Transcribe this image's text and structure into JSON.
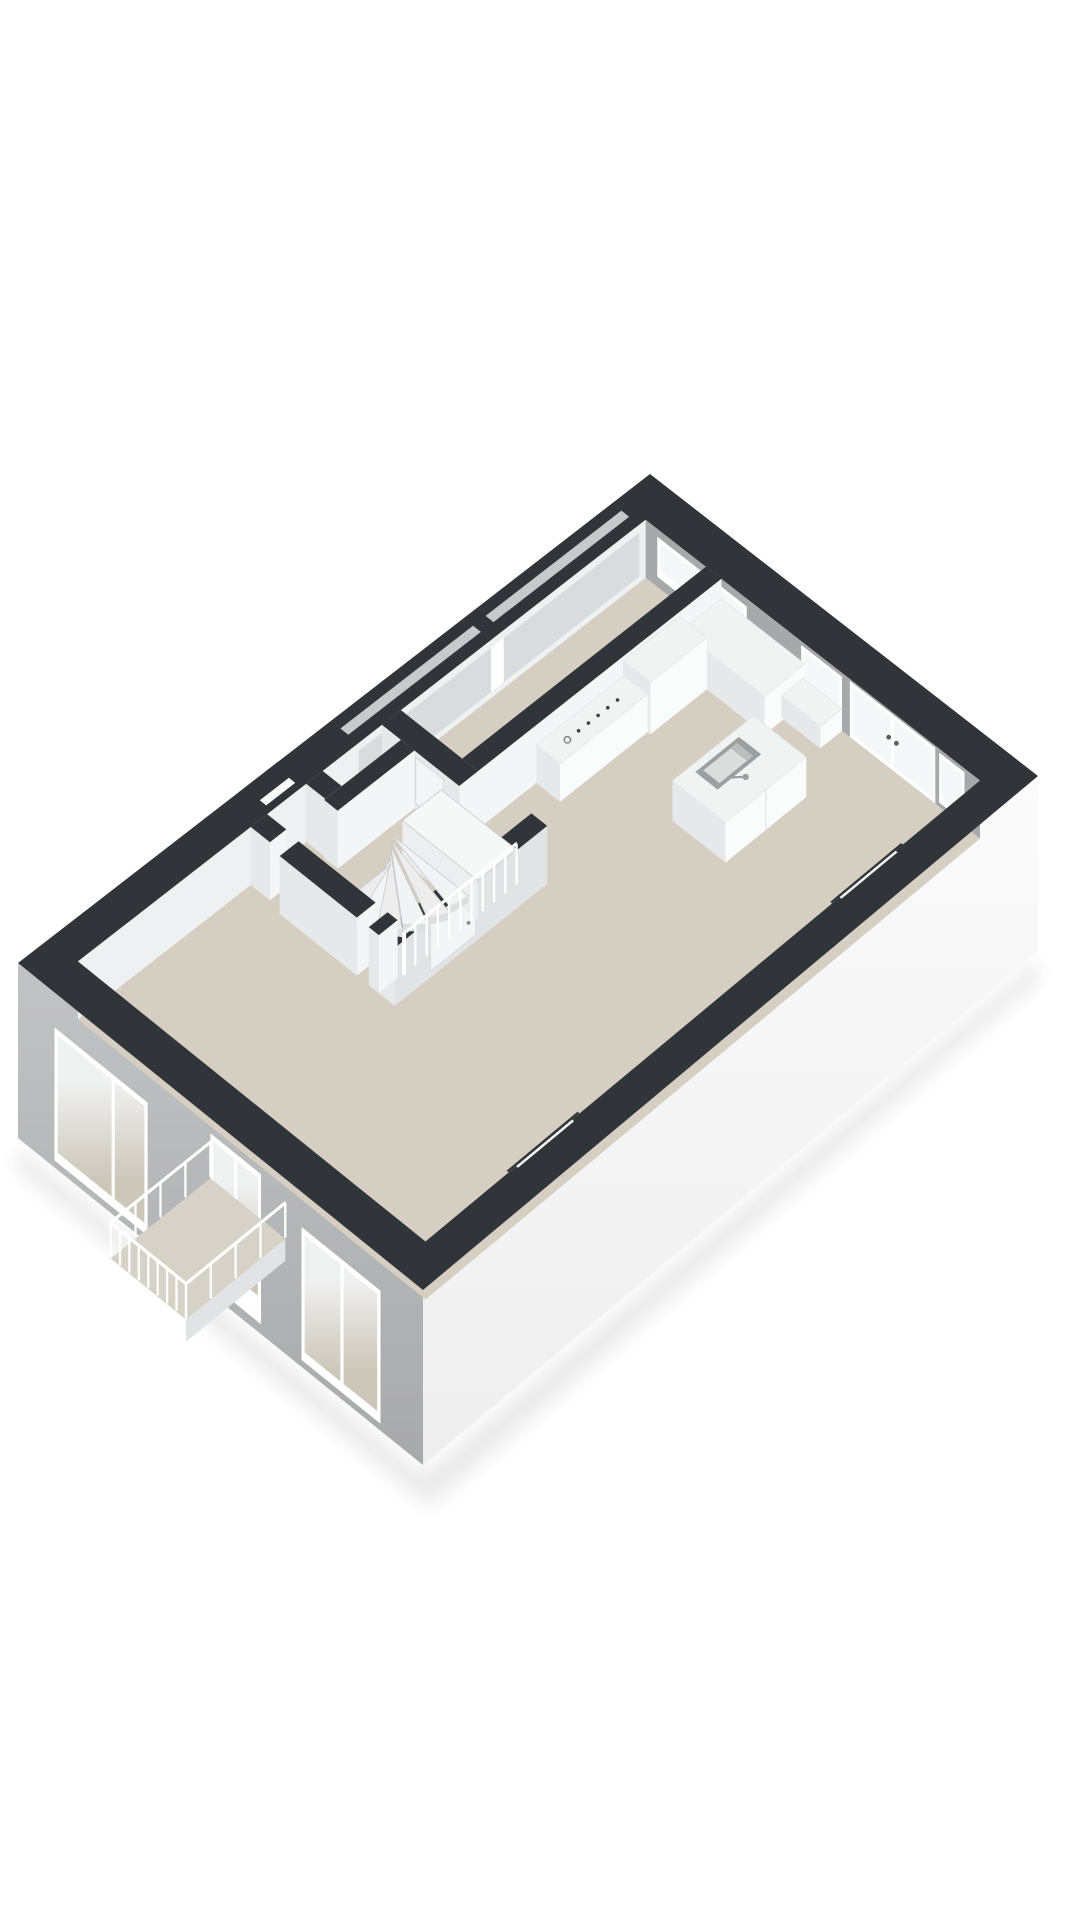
{
  "meta": {
    "figure": "isometric-3d-floorplan-render",
    "floor_label": ""
  },
  "colors": {
    "background": "#ffffff",
    "wallTop": "#313438",
    "floor": "#d5cfc3",
    "floorLight": "#dbd5c9",
    "balconyFloor": "#d7d2c8",
    "neInner": "#a6a8aa",
    "nwInner": "#eff0f2",
    "nwGlazing": "#d9dcdd",
    "bandCutGlass": "#c7cacc",
    "seFaceTop": "#fbfbfb",
    "seFaceBot": "#eeeeee",
    "swFaceTop": "#c2c3c5",
    "swFaceBot": "#a8a9ab",
    "glassNE": "#f5f7f8",
    "glassSWTop": "#eff0f0",
    "glassSWBot": "#cdc7bb",
    "frame": "#ffffff",
    "frameShade": "#e2e3e5",
    "wallFaceSE": "#f4f5f6",
    "wallFaceSW": "#e7e8ea",
    "wallFaceShaded": "#e2e3e5",
    "boxTop": "#f1f2f2",
    "boxSE": "#fafbfb",
    "boxSW": "#e7e8e9",
    "treads": "#f2f3f4",
    "treadEdge": "#c9cacc",
    "landing": "#f6f7f7",
    "rail": "#ffffff",
    "railShade": "#d8d9db",
    "sinkRim": "#9aa0a0",
    "sinkBasin": "#d9dddc",
    "sinkShadow": "#b9bebd",
    "faucet": "#9aa0a2",
    "handle": "#5b5e60",
    "doorLeaf": "#f3f4f5",
    "doorFrame": "#d8d9db",
    "shadow": "#3a3b40"
  },
  "scene": {
    "corners": {
      "n": [
        650,
        474
      ],
      "e": [
        1038,
        776
      ],
      "w": [
        18,
        963
      ],
      "s": [
        423,
        1290
      ]
    },
    "ta": 0.07,
    "tb": 0.05,
    "floorZ": -58,
    "slabZ": -175,
    "ne_openings": [
      {
        "name": "ne-window-double",
        "a1": 0.1,
        "a2": 0.33,
        "z1": -8,
        "z2": -48,
        "mullions": [
          0.215
        ],
        "door": false
      },
      {
        "name": "ne-window-tall",
        "a1": 0.47,
        "a2": 0.575,
        "z1": -4,
        "z2": -54,
        "mullions": [],
        "door": false
      },
      {
        "name": "ne-french-doors",
        "a1": 0.595,
        "a2": 0.815,
        "z1": -2,
        "z2": -58,
        "mullions": [
          0.705
        ],
        "door": true,
        "handles": [
          [
            0.695,
            -28
          ],
          [
            0.715,
            -28
          ]
        ]
      },
      {
        "name": "ne-window-side",
        "a1": 0.825,
        "a2": 0.89,
        "z1": -4,
        "z2": -54,
        "mullions": [],
        "door": false
      }
    ],
    "sw_openings": [
      {
        "name": "sw-window-a",
        "a1": 0.09,
        "a2": 0.32,
        "z1": -35,
        "z2": -168,
        "mullions": [
          0.235
        ],
        "door": false
      },
      {
        "name": "sw-balcony-doors",
        "a1": 0.475,
        "a2": 0.6,
        "z1": -15,
        "z2": -165,
        "mullions": [
          0.5375
        ],
        "door": true,
        "handles": [
          [
            0.528,
            -82
          ],
          [
            0.548,
            -82
          ]
        ]
      },
      {
        "name": "sw-window-b",
        "a1": 0.7,
        "a2": 0.895,
        "z1": -35,
        "z2": -168,
        "mullions": [
          0.8
        ],
        "door": false
      }
    ],
    "nw_glazing": {
      "b1": 0.06,
      "b2": 0.505,
      "z1": -8,
      "z2": -52,
      "gap1": 0.275,
      "gap2": 0.295,
      "cut_a1": 0.024,
      "cut_a2": 0.044
    },
    "entry_niche": {
      "b1": 0.588,
      "b2": 0.65,
      "depth": 0.055
    },
    "se_niches": [
      {
        "name": "se-niche-upper",
        "b1": 0.175,
        "b2": 0.29
      },
      {
        "name": "se-niche-lower",
        "b1": 0.7,
        "b2": 0.815
      }
    ],
    "niche_depth_a": 0.925,
    "niche_inset": 0.012,
    "walls": {
      "w1": {
        "a1": 0.225,
        "a2": 0.265,
        "b1": 0.05,
        "b2": 0.438
      },
      "w2": {
        "a1": 0.07,
        "a2": 0.265,
        "b1": 0.438,
        "b2": 0.468,
        "door": {
          "a1": 0.155,
          "a2": 0.225
        }
      },
      "stub1": {
        "a1": 0.07,
        "a2": 0.118,
        "b1": 0.562,
        "b2": 0.588
      },
      "stub2": {
        "a1": 0.07,
        "a2": 0.118,
        "b1": 0.65,
        "b2": 0.676
      },
      "w4": {
        "a1": 0.118,
        "a2": 0.152,
        "b1": 0.468,
        "b2": 0.59
      },
      "w3": {
        "a1": 0.4,
        "a2": 0.44,
        "b1": 0.438,
        "b2": 0.682,
        "door": {
          "b1": 0.552,
          "b2": 0.625
        }
      },
      "w5": {
        "a1": 0.152,
        "a2": 0.345,
        "b1": 0.652,
        "b2": 0.682
      },
      "w5post": {
        "a1": 0.375,
        "a2": 0.4,
        "b1": 0.652,
        "b2": 0.682
      }
    },
    "kitchen": {
      "counter_ne": {
        "a1": 0.265,
        "a2": 0.48,
        "b1": 0.05,
        "b2": 0.115,
        "z": -20
      },
      "cabinet_tall": {
        "a1": 0.262,
        "a2": 0.332,
        "b1": 0.115,
        "b2": 0.205,
        "z": -6
      },
      "counter_w1": {
        "a1": 0.265,
        "a2": 0.325,
        "b1": 0.205,
        "b2": 0.345,
        "z": -20
      },
      "ledge_ne": {
        "a1": 0.475,
        "a2": 0.575,
        "b1": 0.05,
        "b2": 0.085,
        "z": -36
      },
      "cooktop": {
        "a": 0.296,
        "b_start": 0.235,
        "b_step": 0.0155,
        "dots": 5,
        "ring_b": 0.315
      }
    },
    "island": {
      "a1": 0.5,
      "a2": 0.635,
      "b1": 0.145,
      "b2": 0.275,
      "z": -18,
      "sink": {
        "a1": 0.515,
        "a2": 0.572,
        "b1": 0.178,
        "b2": 0.248,
        "inset": 0.008
      },
      "faucet": {
        "a": 0.588,
        "b": 0.213
      }
    },
    "stairs": {
      "landing": {
        "a1": 0.22,
        "a2": 0.41,
        "b1": 0.468,
        "b2": 0.53,
        "z": -18
      },
      "newel": [
        0.215,
        0.545
      ],
      "ra": 0.195,
      "rb": 0.098,
      "tread_z": [
        -26,
        -32,
        -38,
        -44,
        -50,
        -56
      ],
      "rail": {
        "a": 0.41,
        "b1": 0.468,
        "b2": 0.648,
        "zTop": -10,
        "zBot": -52,
        "balusters": 10
      }
    },
    "balcony": {
      "a1": 0.475,
      "a2": 0.66,
      "bOut": 1.16,
      "zFloor": -60,
      "zFasciaBot": -82,
      "zRailTop": -22,
      "zRailBot": -58,
      "nSide": 4,
      "nFront": 8
    }
  }
}
